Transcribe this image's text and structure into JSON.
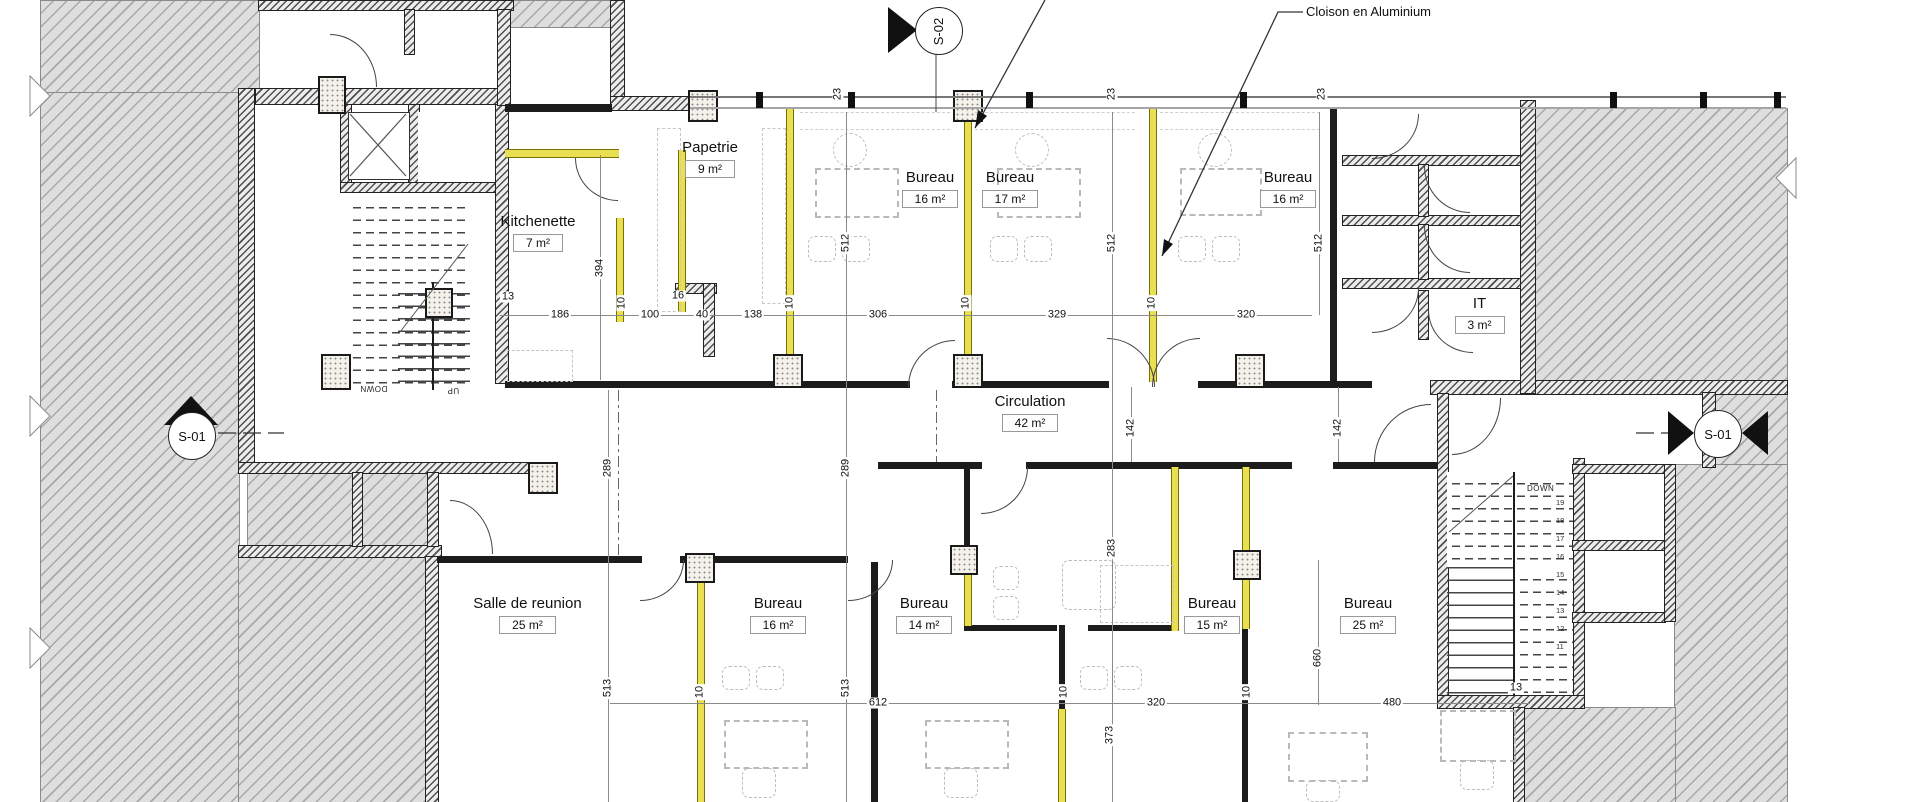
{
  "annotations": {
    "cloison": "Cloison en Aluminium"
  },
  "markers": {
    "s02": "S-02",
    "s01_left": "S-01",
    "s01_right": "S-01"
  },
  "stair_labels": {
    "down_left": "DOWN",
    "up_left": "UP",
    "down_right": "DOWN"
  },
  "stair_numbers_right": [
    "19",
    "18",
    "17",
    "16",
    "15",
    "14",
    "13",
    "12",
    "11"
  ],
  "colors": {
    "partition_yellow": "#e9df52",
    "hatch_gray": "#a8a8a8"
  },
  "rooms": {
    "papetrie": {
      "name": "Papetrie",
      "area": "9 m²"
    },
    "kitchenette": {
      "name": "Kitchenette",
      "area": "7 m²"
    },
    "bureau_t1": {
      "name": "Bureau",
      "area": "16 m²"
    },
    "bureau_t2": {
      "name": "Bureau",
      "area": "17 m²"
    },
    "bureau_t3": {
      "name": "Bureau",
      "area": "16 m²"
    },
    "it": {
      "name": "IT",
      "area": "3 m²"
    },
    "circulation": {
      "name": "Circulation",
      "area": "42 m²"
    },
    "salle": {
      "name": "Salle de reunion",
      "area": "25 m²"
    },
    "bureau_b1": {
      "name": "Bureau",
      "area": "16 m²"
    },
    "bureau_b2": {
      "name": "Bureau",
      "area": "14 m²"
    },
    "bureau_b3": {
      "name": "Bureau",
      "area": "15 m²"
    },
    "bureau_b4": {
      "name": "Bureau",
      "area": "25 m²"
    }
  },
  "dims": {
    "d13a": "13",
    "d186": "186",
    "d10a": "10",
    "d100": "100",
    "d16": "16",
    "d40": "40",
    "d138": "138",
    "d10b": "10",
    "d306": "306",
    "d10c": "10",
    "d329": "329",
    "d10d": "10",
    "d320a": "320",
    "d23a": "23",
    "d23b": "23",
    "d23c": "23",
    "d394": "394",
    "d512a": "512",
    "d512b": "512",
    "d512c": "512",
    "d289a": "289",
    "d289b": "289",
    "d142a": "142",
    "d142b": "142",
    "d283": "283",
    "d513a": "513",
    "d513b": "513",
    "d612": "612",
    "d10e": "10",
    "d10f": "10",
    "d320b": "320",
    "d10g": "10",
    "d373": "373",
    "d660": "660",
    "d480": "480",
    "d13b": "13"
  }
}
